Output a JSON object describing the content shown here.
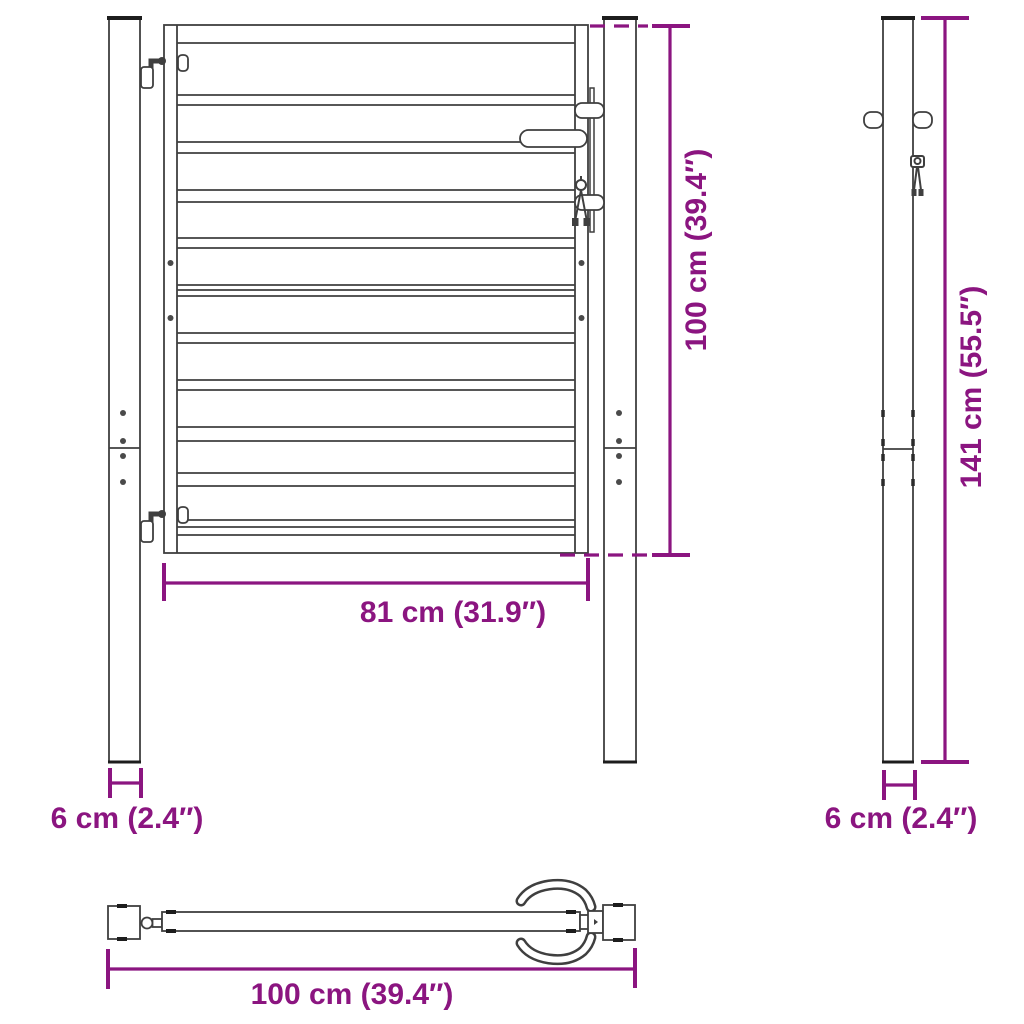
{
  "title": "Garden gate technical dimension drawing",
  "colors": {
    "dimension_accent": "#8b1580",
    "line": "#3f3f3f",
    "line_dark": "#1d1d1d",
    "background": "#ffffff"
  },
  "labels": {
    "front_gate_height": "100 cm (39.4″)",
    "front_gate_width": "81 cm (31.9″)",
    "front_post_width": "6 cm (2.4″)",
    "side_post_height": "141 cm (55.5″)",
    "side_post_width": "6 cm (2.4″)",
    "top_total_width": "100 cm (39.4″)"
  },
  "views": {
    "front": "front elevation of gate with two posts",
    "side": "side elevation of post",
    "top": "top plan view of gate"
  }
}
